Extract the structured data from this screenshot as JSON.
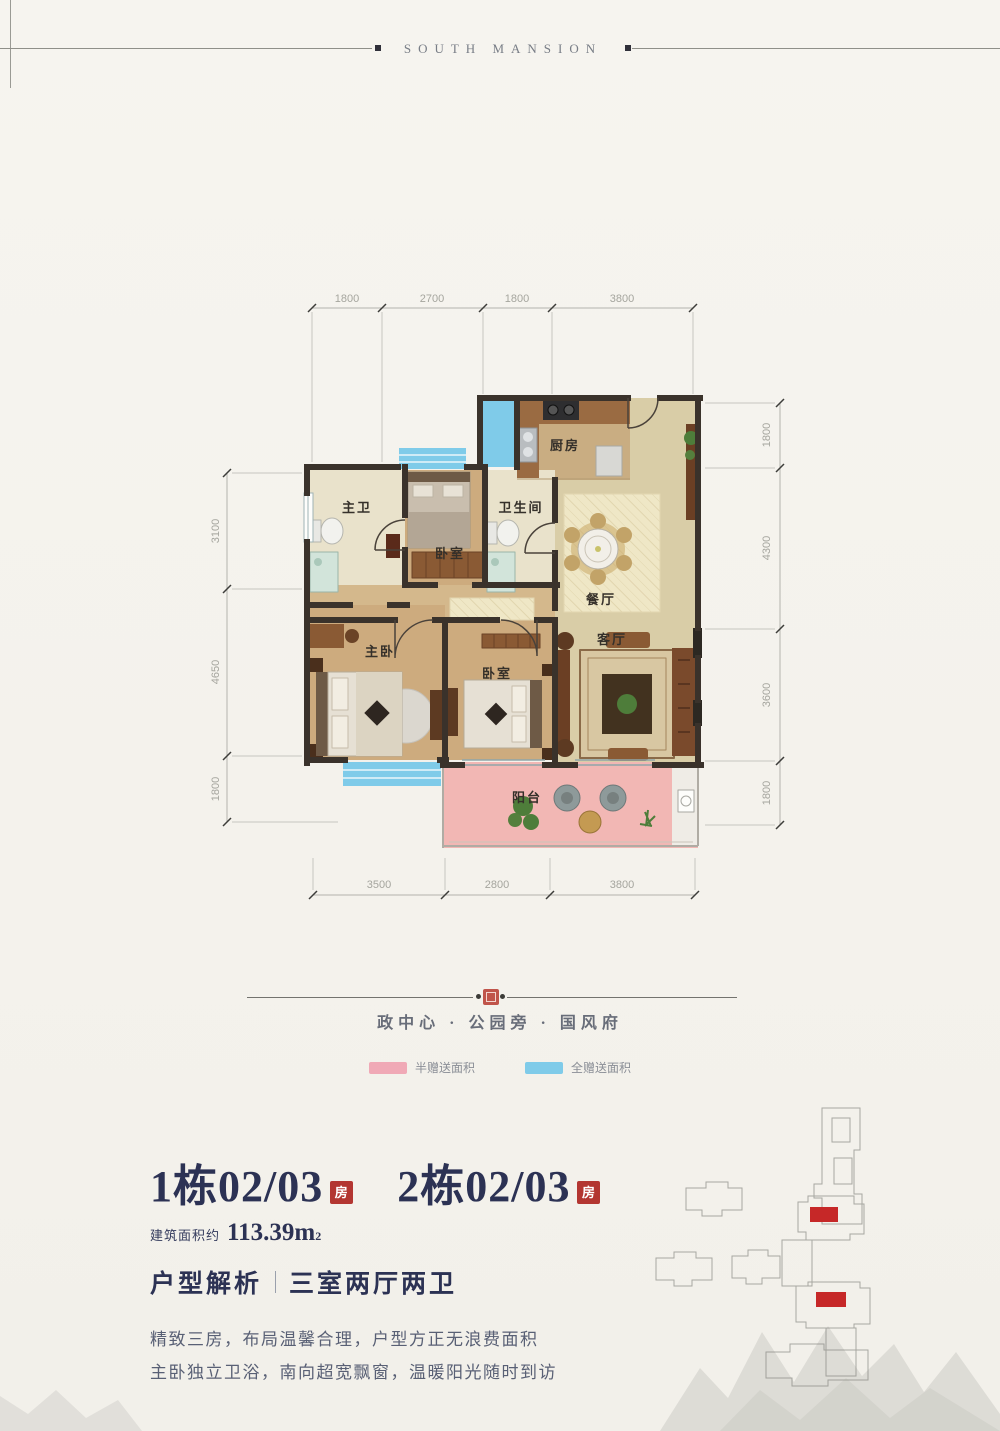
{
  "header": {
    "brand": "SOUTH MANSION"
  },
  "floorplan": {
    "dims_top": [
      "1800",
      "2700",
      "1800",
      "3800"
    ],
    "dims_left": [
      "3100",
      "4650",
      "1800"
    ],
    "dims_right": [
      "1800",
      "4300",
      "3600",
      "1800"
    ],
    "dims_bottom": [
      "3500",
      "2800",
      "3800"
    ],
    "rooms": {
      "master_bath": "主卫",
      "bedroom_top": "卧室",
      "bathroom": "卫生间",
      "kitchen": "厨房",
      "dining": "餐厅",
      "living": "客厅",
      "master_bedroom": "主卧",
      "bedroom_bottom": "卧室",
      "balcony": "阳台"
    }
  },
  "divider": {
    "slogan": "政中心 · 公园旁 · 国风府"
  },
  "legend": {
    "half_gift": {
      "label": "半赠送面积",
      "color": "#f0a9b6"
    },
    "full_gift": {
      "label": "全赠送面积",
      "color": "#7fcbe9"
    }
  },
  "info": {
    "unit1": "1栋02/03",
    "unit1_badge": "房",
    "unit2": "2栋02/03",
    "unit2_badge": "房",
    "area_label": "建筑面积约",
    "area_value": "113.39m",
    "area_sup": "2",
    "analysis_label": "户型解析",
    "layout_value": "三室两厅两卫",
    "desc1": "精致三房，布局温馨合理，户型方正无浪费面积",
    "desc2": "主卧独立卫浴，南向超宽飘窗，温暖阳光随时到访"
  },
  "colors": {
    "navy": "#2c3254",
    "badge_red": "#b33631",
    "seal_red": "#c0544a",
    "highlight_red": "#c62828",
    "gift_half_pink": "#f0a9b6",
    "gift_full_blue": "#7fcbe9",
    "balcony_pink": "#f2b7b4",
    "wall": "#3a322b"
  }
}
